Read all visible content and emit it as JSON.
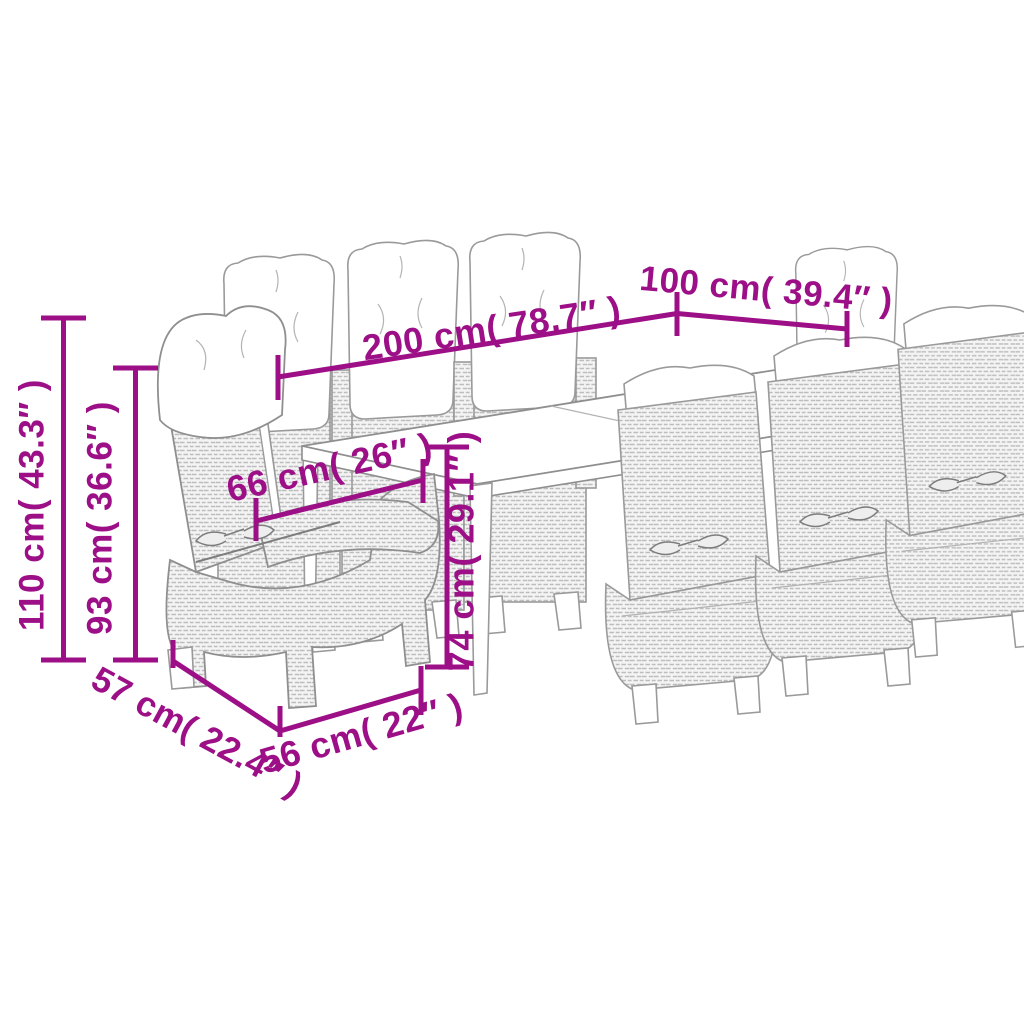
{
  "page": {
    "kind": "product-dimension-diagram",
    "background": "#ffffff",
    "accent_color": "#9C0F87",
    "sketch_line_color": "#8f8f8f"
  },
  "scene": {
    "furniture": "outdoor dining set, poly rattan line drawing with seat and back cushions",
    "table_count": 1,
    "chair_count": 8
  },
  "dimensions": {
    "table_length": "200 cm( 78.7″ )",
    "table_width": "100 cm( 39.4″ )",
    "table_height": "74 cm( 29.1″ )",
    "seat_width": "66 cm( 26″ )",
    "chair_height": "110 cm( 43.3″ )",
    "backrest_height": "93 cm( 36.6″ )",
    "chair_depth": "57 cm( 22.4″ )",
    "chair_width": "56 cm( 22″ )"
  }
}
